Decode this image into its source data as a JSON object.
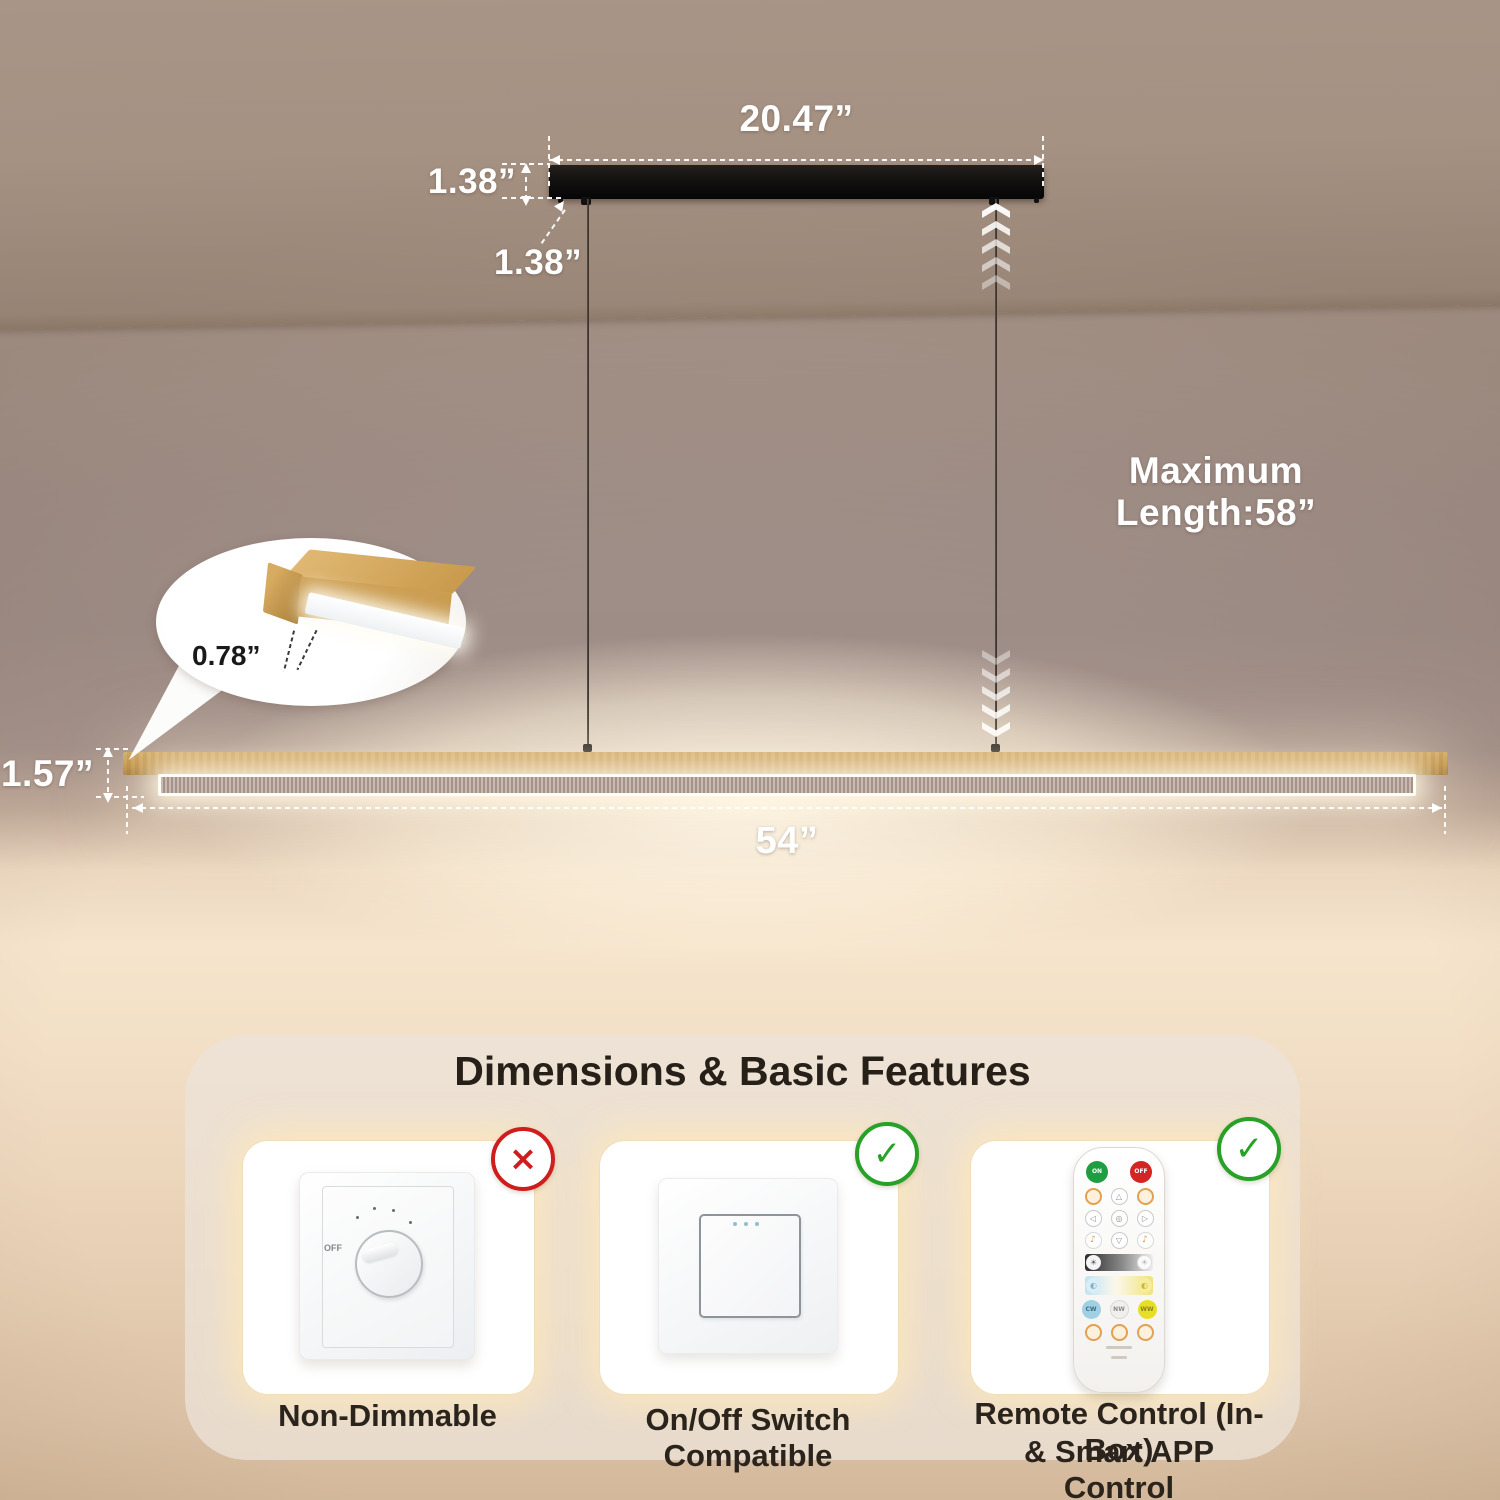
{
  "dimensions": {
    "canopy_width": "20.47”",
    "canopy_height": "1.38”",
    "canopy_offset": "1.38”",
    "max_length": "Maximum Length:58”",
    "bar_end_width": "0.78”",
    "bar_height": "1.57”",
    "bar_length": "54”"
  },
  "panel": {
    "title": "Dimensions & Basic Features",
    "features": [
      {
        "label": "Non-Dimmable",
        "icon": "×",
        "status": "not-supported"
      },
      {
        "label": "On/Off Switch Compatible",
        "icon": "✓",
        "status": "supported"
      },
      {
        "label": "Remote Control (In-Box)",
        "label2": "& Smart APP Control",
        "icon": "✓",
        "status": "supported"
      }
    ]
  },
  "dimmer": {
    "off_label": "OFF"
  },
  "remote": {
    "on_label": "ON",
    "off_label": "OFF",
    "cw_label": "CW",
    "nw_label": "NW",
    "ww_label": "WW"
  },
  "icons": {
    "up_triangle": "△",
    "down_triangle": "▽",
    "left_triangle": "◁",
    "right_triangle": "▷",
    "auto": "◎",
    "music": "♪",
    "sun": "☀",
    "bulb": "◐"
  },
  "colors": {
    "accent_glow": "#ffe7b9",
    "wood": "#c08e3e",
    "canopy": "#131110",
    "ok_green": "#27a127",
    "no_red": "#cf1d1d"
  }
}
